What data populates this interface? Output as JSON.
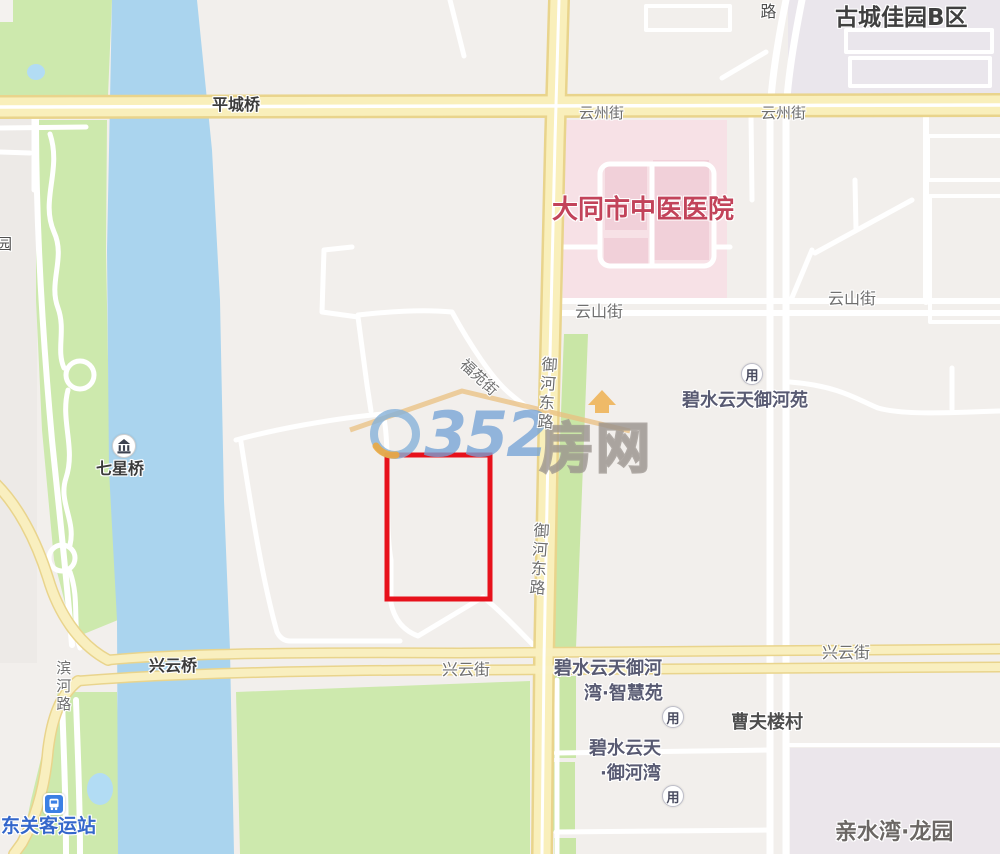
{
  "labels": {
    "top_road_fragment": "路",
    "gucheng_jiayuan": "古城佳园B区",
    "pingcheng_bridge": "平城桥",
    "yunzhou_street_w": "云州街",
    "yunzhou_street_e": "云州街",
    "hospital": "大同市中医医院",
    "yunshan_street_w": "云山街",
    "yunshan_street_e": "云山街",
    "bishui_yuheyuan": "碧水云天御河苑",
    "fuyuan_street": "福苑街",
    "yuhe_east_road_1": "御河东路",
    "yuhe_east_road_2": "御河东路",
    "qixing_bridge": "七星桥",
    "xingyun_bridge": "兴云桥",
    "binhe_road": "滨河路",
    "xingyun_street_w": "兴云街",
    "xingyun_street_e": "兴云街",
    "bishui_yuhewan_zhihui_line1": "碧水云天御河",
    "bishui_yuhewan_zhihui_line2": "湾·智慧苑",
    "caofulou_village": "曹夫楼村",
    "bishui_yuhewan_line1": "碧水云天",
    "bishui_yuhewan_line2": "·御河湾",
    "bus_station": "东关客运站",
    "qinshuiwan_longyuan": "亲水湾·龙园",
    "park_fragment": "园"
  },
  "watermark": {
    "number": "352",
    "suffix": "房网"
  },
  "icons": {
    "community_poi_glyph": "用"
  },
  "colors": {
    "highlight_red": "#e7111b",
    "hospital_text": "#c2435a",
    "bus_text_blue": "#3467cb",
    "road_yellow_fill": "#f9efbb",
    "road_yellow_edge": "#e9d48c",
    "river_blue": "#aad4ee",
    "pond_blue": "#b2dcf4",
    "park_green": "#cde9ad",
    "greenbelt": "#c9e6a6",
    "hospital_pink": "#f7e1e6",
    "hospital_building_pink": "#f1d0d9",
    "residential_lavender": "#eae6ec",
    "background": "#f2efec"
  }
}
